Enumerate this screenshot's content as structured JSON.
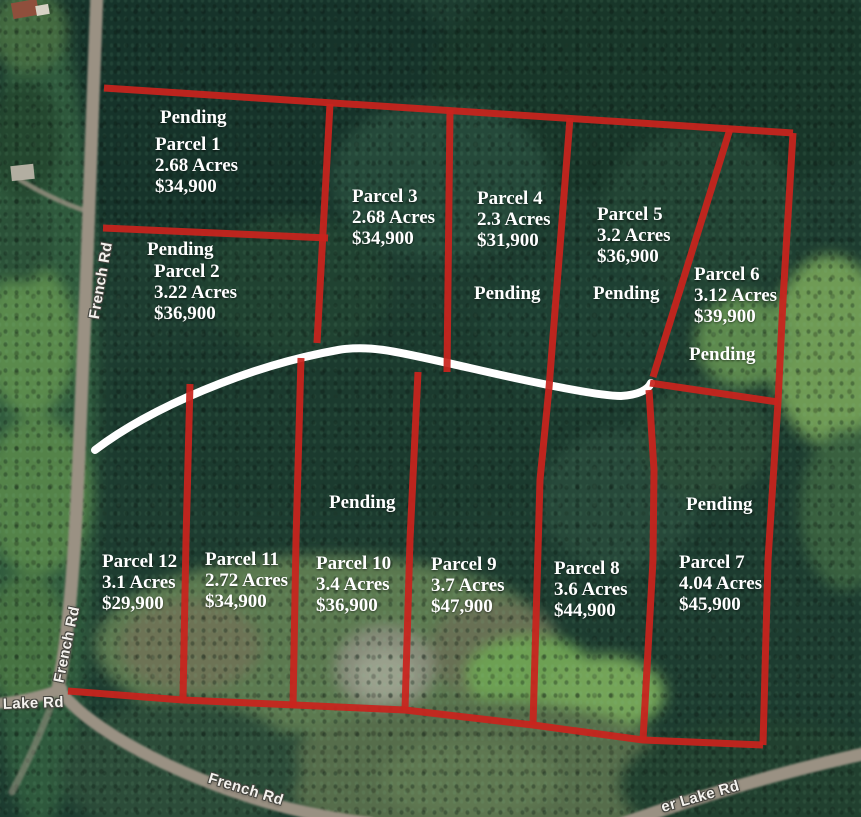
{
  "colors": {
    "boundary-red": "#c9231d",
    "trail-white": "#ffffff",
    "road-gray": "#9a9183",
    "label-white": "#ffffff",
    "forest-dark": "#1d3c30",
    "meadow-olive": "#5c7a50",
    "meadow-bright": "#6f9b55"
  },
  "parcels": [
    {
      "name": "Parcel 1",
      "acres": "2.68 Acres",
      "price": "$34,900",
      "pending": "Pending"
    },
    {
      "name": "Parcel 2",
      "acres": "3.22 Acres",
      "price": "$36,900",
      "pending": "Pending"
    },
    {
      "name": "Parcel 3",
      "acres": "2.68 Acres",
      "price": "$34,900"
    },
    {
      "name": "Parcel 4",
      "acres": "2.3 Acres",
      "price": "$31,900",
      "pending": "Pending"
    },
    {
      "name": "Parcel 5",
      "acres": "3.2 Acres",
      "price": "$36,900",
      "pending": "Pending"
    },
    {
      "name": "Parcel 6",
      "acres": "3.12 Acres",
      "price": "$39,900",
      "pending": "Pending"
    },
    {
      "name": "Parcel 7",
      "acres": "4.04 Acres",
      "price": "$45,900",
      "pending": "Pending"
    },
    {
      "name": "Parcel 8",
      "acres": "3.6 Acres",
      "price": "$44,900"
    },
    {
      "name": "Parcel 9",
      "acres": "3.7 Acres",
      "price": "$47,900"
    },
    {
      "name": "Parcel 10",
      "acres": "3.4 Acres",
      "price": "$36,900",
      "pending": "Pending"
    },
    {
      "name": "Parcel 11",
      "acres": "2.72 Acres",
      "price": "$34,900"
    },
    {
      "name": "Parcel 12",
      "acres": "3.1 Acres",
      "price": "$29,900"
    }
  ],
  "roads": {
    "french_upper": "French Rd",
    "french_lower": "French Rd",
    "french_bottom": "French Rd",
    "lake_west": "r Lake Rd",
    "lake_east": "er Lake Rd"
  }
}
